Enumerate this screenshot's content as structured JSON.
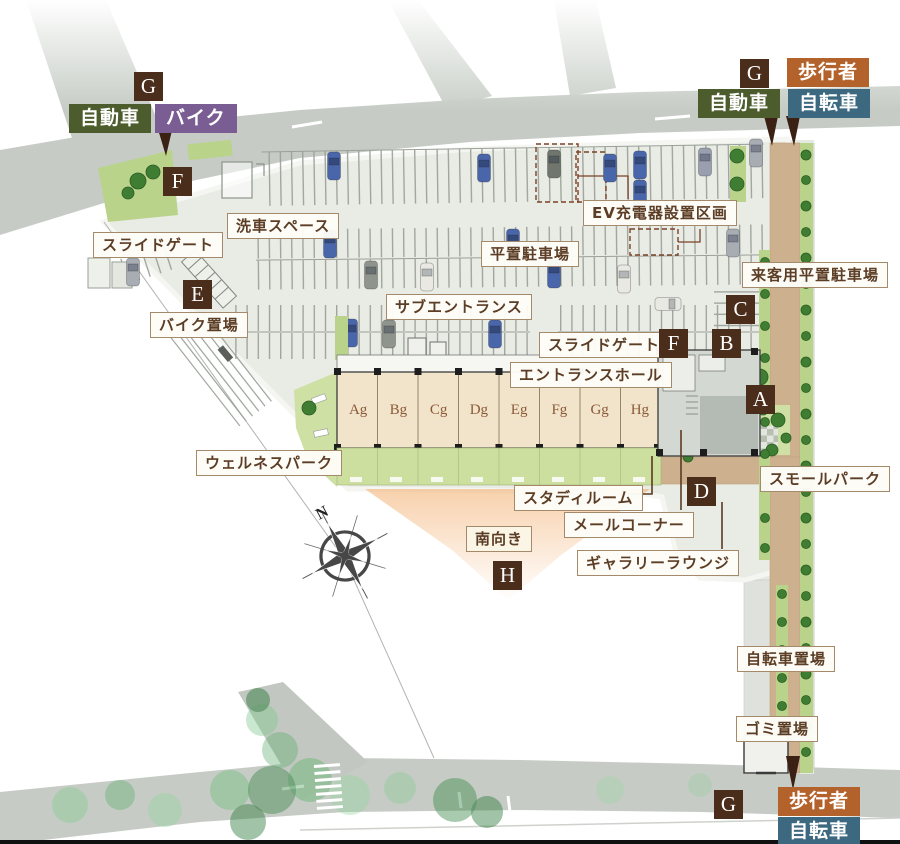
{
  "labels": {
    "slide_gate_west": "スライドゲート",
    "car_wash": "洗車スペース",
    "bike_parking": "バイク置場",
    "sub_entrance": "サブエントランス",
    "flat_parking": "平置駐車場",
    "ev_charger": "EV充電器設置区画",
    "visitor_parking": "来客用平置駐車場",
    "slide_gate_east": "スライドゲート",
    "entrance_hall": "エントランスホール",
    "wellness_park": "ウェルネスパーク",
    "study_room": "スタディルーム",
    "small_park": "スモールパーク",
    "mail_corner": "メールコーナー",
    "south_facing": "南向き",
    "gallery_lounge": "ギャラリーラウンジ",
    "bicycle_parking": "自転車置場",
    "garbage_area": "ゴミ置場"
  },
  "tags": {
    "car": "自動車",
    "bike": "バイク",
    "pedestrian": "歩行者",
    "bicycle": "自転車"
  },
  "markers": {
    "a": "A",
    "b": "B",
    "c": "C",
    "d": "D",
    "e": "E",
    "f": "F",
    "g": "G",
    "h": "H"
  },
  "units": {
    "a": "Ag",
    "b": "Bg",
    "c": "Cg",
    "d": "Dg",
    "e": "Eg",
    "f": "Fg",
    "g": "Gg",
    "h": "Hg"
  },
  "compass": {
    "north": "N"
  },
  "colors": {
    "marker_bg": "#4a2d1b",
    "tag_car": "#4d5c2d",
    "tag_bike": "#7a5e93",
    "tag_pedestrian": "#b4622b",
    "tag_bicycle": "#3c697f",
    "label_border": "#a5896b",
    "label_text": "#5c3d25",
    "road": "#c6ccc5",
    "site_pavement": "#e9ebe5",
    "building": "#f2e4ca",
    "terrace_green": "#cddf9f",
    "path_tan": "#cdb18f",
    "south_glow": "#f0a055"
  }
}
